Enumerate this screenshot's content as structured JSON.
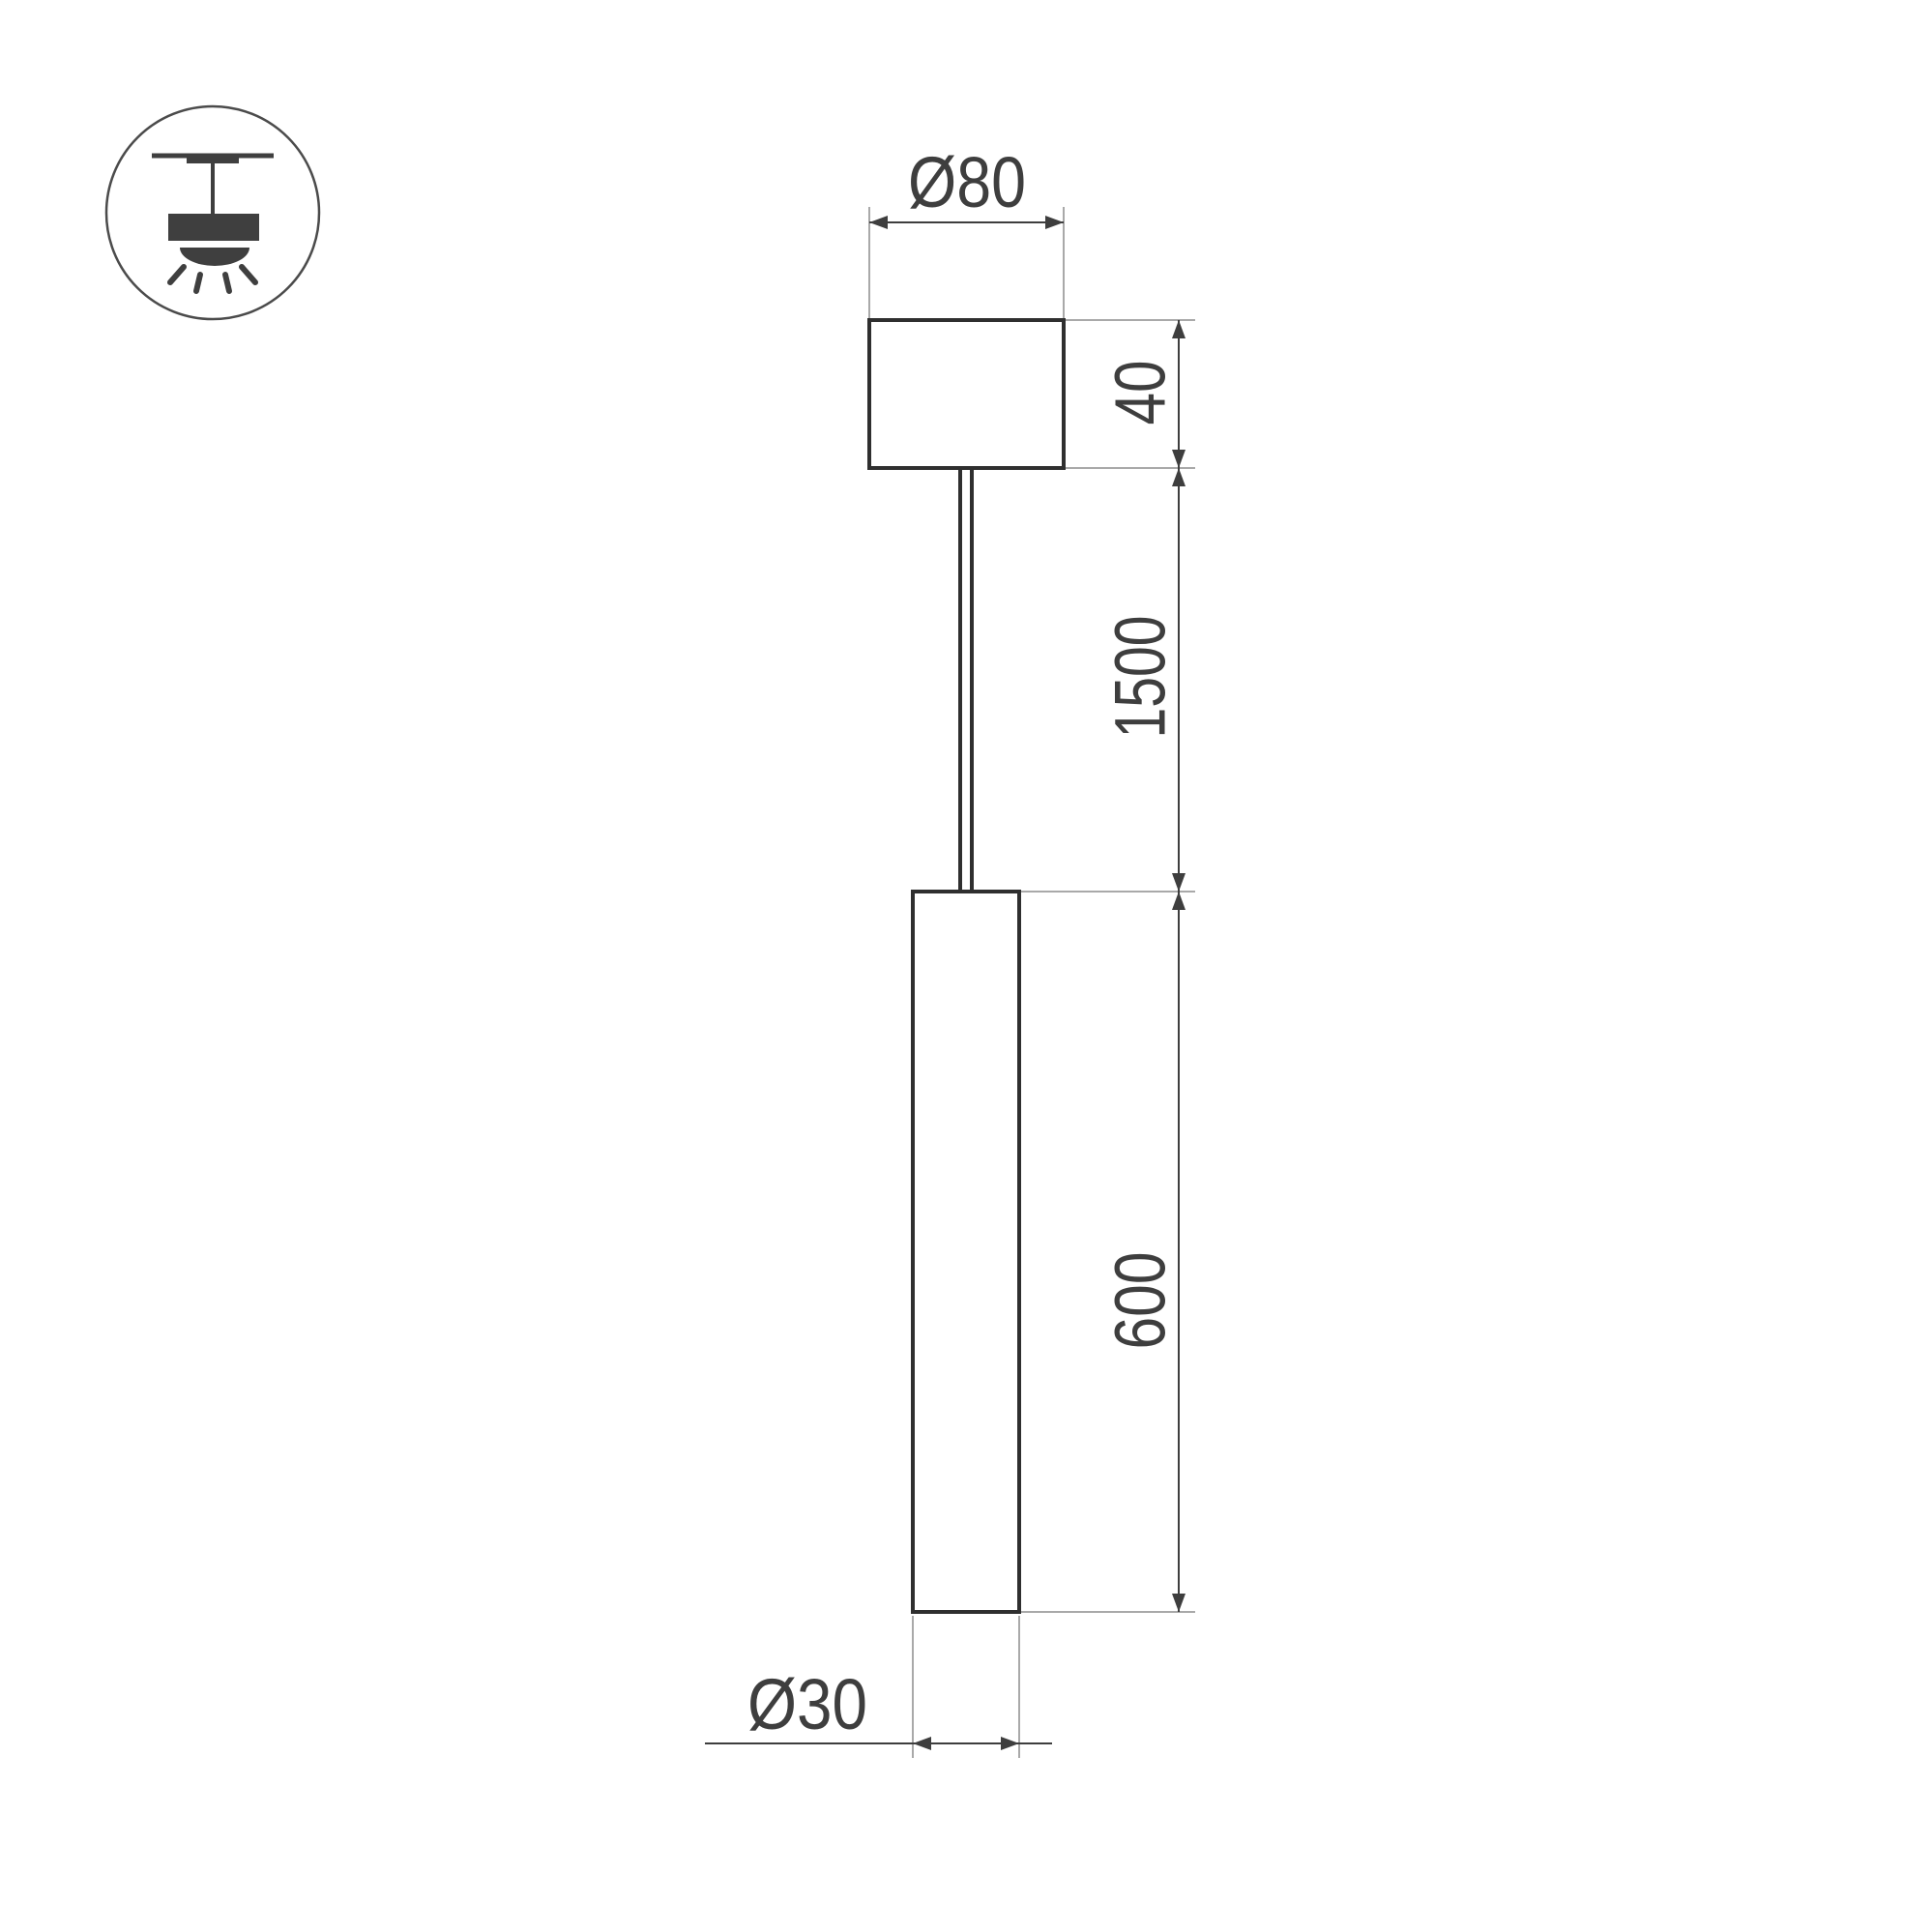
{
  "labels": {
    "canopy_diameter": "Ø80",
    "canopy_height": "40",
    "suspension_length": "1500",
    "tube_length": "600",
    "tube_diameter": "Ø30"
  },
  "icon": {
    "name": "ceiling-pendant-light-icon"
  },
  "colors": {
    "background": "#ffffff",
    "object_line": "#2f2f2f",
    "dimension_line": "#3e3e3e",
    "extension_line": "#a9a9a9",
    "text": "#3e3e3e",
    "icon_glyph": "#3f3f3f",
    "icon_circle_stroke": "#4b4b4b"
  }
}
